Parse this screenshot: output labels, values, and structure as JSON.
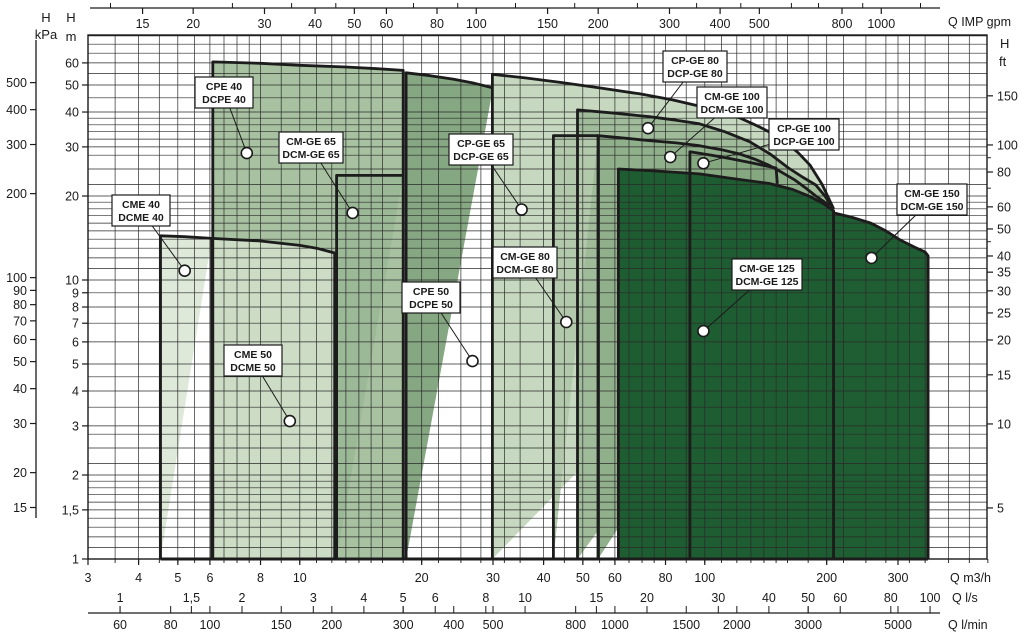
{
  "chart_data": {
    "type": "area",
    "title": "Pump operating range chart",
    "grid": true,
    "scales": {
      "x_log_px": {
        "x0": 88,
        "q0": 3,
        "px_per_decade": 405,
        "right_px": 987
      },
      "y_log_px": {
        "y0": 559,
        "h0": 1,
        "px_per_decade": 279,
        "top_px": 35
      },
      "xlim_m3h": [
        3,
        520
      ],
      "ylim_m": [
        1,
        75
      ]
    },
    "axes": {
      "top_gpm": {
        "label": "Q IMP gpm",
        "factor_to_m3h": 0.27276,
        "ticks": [
          [
            15,
            "15"
          ],
          [
            20,
            "20"
          ],
          [
            30,
            "30"
          ],
          [
            40,
            "40"
          ],
          [
            50,
            "50"
          ],
          [
            60,
            "60"
          ],
          [
            80,
            "80"
          ],
          [
            100,
            "100"
          ],
          [
            150,
            "150"
          ],
          [
            200,
            "200"
          ],
          [
            300,
            "300"
          ],
          [
            400,
            "400"
          ],
          [
            500,
            "500"
          ],
          [
            800,
            "800"
          ],
          [
            1000,
            "1000"
          ]
        ],
        "minor_ticks": [
          12.5,
          25,
          35,
          45,
          70,
          90,
          125,
          175,
          250,
          350,
          450,
          600,
          700,
          900,
          1250,
          1500
        ]
      },
      "bottom_m3h": {
        "label": "Q m3/h",
        "ticks": [
          [
            3,
            "3"
          ],
          [
            4,
            "4"
          ],
          [
            5,
            "5"
          ],
          [
            6,
            "6"
          ],
          [
            8,
            "8"
          ],
          [
            10,
            "10"
          ],
          [
            20,
            "20"
          ],
          [
            30,
            "30"
          ],
          [
            40,
            "40"
          ],
          [
            50,
            "50"
          ],
          [
            60,
            "60"
          ],
          [
            80,
            "80"
          ],
          [
            100,
            "100"
          ],
          [
            200,
            "200"
          ],
          [
            300,
            "300"
          ]
        ]
      },
      "bottom_ls": {
        "label": "Q l/s",
        "factor_to_m3h": 3.6,
        "ticks": [
          [
            1,
            "1"
          ],
          [
            1.5,
            "1,5"
          ],
          [
            2,
            "2"
          ],
          [
            3,
            "3"
          ],
          [
            4,
            "4"
          ],
          [
            5,
            "5"
          ],
          [
            6,
            "6"
          ],
          [
            8,
            "8"
          ],
          [
            10,
            "10"
          ],
          [
            15,
            "15"
          ],
          [
            20,
            "20"
          ],
          [
            30,
            "30"
          ],
          [
            40,
            "40"
          ],
          [
            50,
            "50"
          ],
          [
            60,
            "60"
          ],
          [
            80,
            "80"
          ],
          [
            100,
            "100"
          ]
        ]
      },
      "bottom_lmin": {
        "label": "Q l/min",
        "factor_to_m3h": 0.06,
        "ticks": [
          [
            60,
            "60"
          ],
          [
            80,
            "80"
          ],
          [
            100,
            "100"
          ],
          [
            150,
            "150"
          ],
          [
            200,
            "200"
          ],
          [
            300,
            "300"
          ],
          [
            400,
            "400"
          ],
          [
            500,
            "500"
          ],
          [
            800,
            "800"
          ],
          [
            1000,
            "1000"
          ],
          [
            1500,
            "1500"
          ],
          [
            2000,
            "2000"
          ],
          [
            3000,
            "3000"
          ],
          [
            5000,
            "5000"
          ]
        ]
      },
      "left_kpa": {
        "label_top": "H",
        "label_unit": "kPa",
        "factor_to_m": 0.10197,
        "ticks": [
          [
            500,
            "500"
          ],
          [
            400,
            "400"
          ],
          [
            300,
            "300"
          ],
          [
            200,
            "200"
          ],
          [
            100,
            "100"
          ],
          [
            90,
            "90"
          ],
          [
            80,
            "80"
          ],
          [
            70,
            "70"
          ],
          [
            60,
            "60"
          ],
          [
            50,
            "50"
          ],
          [
            40,
            "40"
          ],
          [
            30,
            "30"
          ],
          [
            20,
            "20"
          ],
          [
            15,
            "15"
          ]
        ]
      },
      "left_m": {
        "label_top": "H",
        "label_unit": "m",
        "ticks": [
          [
            60,
            "60"
          ],
          [
            50,
            "50"
          ],
          [
            40,
            "40"
          ],
          [
            30,
            "30"
          ],
          [
            20,
            "20"
          ],
          [
            10,
            "10"
          ],
          [
            9,
            "9"
          ],
          [
            8,
            "8"
          ],
          [
            7,
            "7"
          ],
          [
            6,
            "6"
          ],
          [
            5,
            "5"
          ],
          [
            4,
            "4"
          ],
          [
            3,
            "3"
          ],
          [
            2,
            "2"
          ],
          [
            1.5,
            "1,5"
          ],
          [
            1,
            "1"
          ]
        ]
      },
      "right_ft": {
        "label_top": "H",
        "label_unit": "ft",
        "factor_to_m": 0.3048,
        "ticks": [
          [
            150,
            "150"
          ],
          [
            100,
            "100"
          ],
          [
            80,
            "80"
          ],
          [
            60,
            "60"
          ],
          [
            50,
            "50"
          ],
          [
            40,
            "40"
          ],
          [
            35,
            "35"
          ],
          [
            30,
            "30"
          ],
          [
            25,
            "25"
          ],
          [
            20,
            "20"
          ],
          [
            15,
            "15"
          ],
          [
            10,
            "10"
          ],
          [
            5,
            "5"
          ]
        ],
        "minor_ticks": [
          90,
          70,
          45
        ]
      }
    },
    "grid_values": {
      "x_m3h": [
        3,
        3.5,
        4,
        4.5,
        5,
        5.5,
        6,
        6.5,
        7,
        7.5,
        8,
        9,
        10,
        11,
        12,
        13,
        14,
        15,
        16,
        18,
        20,
        22,
        25,
        28,
        30,
        32,
        35,
        40,
        45,
        50,
        55,
        60,
        65,
        70,
        75,
        80,
        90,
        100,
        110,
        120,
        130,
        140,
        150,
        160,
        180,
        200,
        220,
        250,
        280,
        300,
        320,
        350,
        400,
        450,
        500
      ],
      "y_m": [
        1,
        1.1,
        1.2,
        1.3,
        1.4,
        1.5,
        1.6,
        1.7,
        1.8,
        1.9,
        2,
        2.2,
        2.5,
        2.8,
        3,
        3.5,
        4,
        4.5,
        5,
        6,
        7,
        8,
        9,
        10,
        11,
        12,
        13,
        14,
        15,
        16,
        17,
        18,
        19,
        20,
        22,
        25,
        28,
        30,
        32,
        34,
        36,
        38,
        40,
        45,
        50,
        55,
        60,
        65,
        70,
        75
      ]
    },
    "envelopes": [
      {
        "id": "cpe-40",
        "lines": [
          "CPE 40",
          "DCPE 40"
        ],
        "fill": "#a8c2a1",
        "outline": [
          [
            6.1,
            1
          ],
          [
            6.1,
            60.5
          ],
          [
            8,
            59.8
          ],
          [
            10,
            58.8
          ],
          [
            13,
            58
          ],
          [
            15.5,
            57.2
          ],
          [
            18,
            56.4
          ],
          [
            18,
            1
          ]
        ],
        "close": true,
        "dot": [
          7.4,
          28.5
        ],
        "box": [
          195,
          77,
          58,
          31
        ]
      },
      {
        "id": "cme-50",
        "lines": [
          "CME 50",
          "DCME 50"
        ],
        "fill": "#ccdcc5",
        "outline": [
          [
            6.06,
            1
          ],
          [
            6.06,
            14.1
          ],
          [
            8,
            13.8
          ],
          [
            10,
            13.3
          ],
          [
            11,
            13
          ],
          [
            12.2,
            12.5
          ],
          [
            12.2,
            1
          ]
        ],
        "close": true,
        "dot": [
          9.45,
          3.12
        ],
        "box": [
          224,
          345,
          58,
          31
        ]
      },
      {
        "id": "cme-40",
        "lines": [
          "CME 40",
          "DCME 40"
        ],
        "fill": "#dfe9da",
        "outline": [
          [
            4.53,
            1
          ],
          [
            4.53,
            14.4
          ],
          [
            5.2,
            14.3
          ],
          [
            6.06,
            14.1
          ]
        ],
        "close": true,
        "dot": [
          5.2,
          10.8
        ],
        "box": [
          112,
          195,
          58,
          31
        ]
      },
      {
        "id": "cm-ge-65",
        "lines": [
          "CM-GE 65",
          "DCM-GE 65"
        ],
        "fill": "#9cb997",
        "outline": [
          [
            12.33,
            1
          ],
          [
            12.33,
            23.7
          ],
          [
            18,
            23.7
          ]
        ],
        "close": true,
        "dot": [
          13.5,
          17.4
        ],
        "box": [
          279,
          132,
          64,
          31
        ]
      },
      {
        "id": "cpe-50",
        "lines": [
          "CPE 50",
          "DCPE 50"
        ],
        "fill": "#85a781",
        "outline": [
          [
            18.3,
            1
          ],
          [
            18.3,
            55.3
          ],
          [
            21,
            54
          ],
          [
            24,
            52.4
          ],
          [
            27,
            50.7
          ],
          [
            30,
            48.8
          ]
        ],
        "close": true,
        "dot": [
          26.7,
          5.12
        ],
        "box": [
          402,
          282,
          58,
          31
        ]
      },
      {
        "id": "cp-ge-65",
        "lines": [
          "CP-GE 65",
          "DCP-GE 65"
        ],
        "fill": "#c6d8bf",
        "outline": [
          [
            29.9,
            1
          ],
          [
            29.9,
            54.6
          ],
          [
            36,
            53
          ],
          [
            44,
            51.1
          ],
          [
            55,
            48.8
          ],
          [
            69,
            46.5
          ],
          [
            83,
            44.3
          ],
          [
            97,
            42
          ],
          [
            110,
            39.9
          ],
          [
            122,
            38.1
          ],
          [
            137,
            35.3
          ],
          [
            154,
            32.3
          ],
          [
            170,
            28.6
          ],
          [
            182,
            25.8
          ],
          [
            195,
            22
          ],
          [
            208,
            18
          ]
        ],
        "close": true,
        "dot": [
          35.3,
          17.9
        ],
        "box": [
          449,
          134,
          64,
          31
        ]
      },
      {
        "id": "cp-ge-80",
        "lines": [
          "CP-GE 80",
          "DCP-GE 80"
        ],
        "fill": "#a0bb9a",
        "outline": [
          [
            48.5,
            1
          ],
          [
            48.5,
            40.7
          ],
          [
            60,
            39.6
          ],
          [
            73,
            38.5
          ],
          [
            85,
            37.4
          ],
          [
            97,
            36.3
          ],
          [
            112,
            34
          ],
          [
            129,
            31.3
          ],
          [
            145,
            28.3
          ],
          [
            161,
            25.2
          ],
          [
            175,
            23.3
          ],
          [
            188,
            21.9
          ],
          [
            198,
            20
          ],
          [
            207,
            18.1
          ]
        ],
        "close": true,
        "dot": [
          72.4,
          35.0
        ],
        "box": [
          663,
          51,
          64,
          31
        ]
      },
      {
        "id": "cm-ge-80",
        "lines": [
          "CM-GE 80",
          "DCM-GE 80"
        ],
        "fill": "#b3c9ac",
        "outline": [
          [
            42.3,
            1
          ],
          [
            42.3,
            32.9
          ],
          [
            54.5,
            32.9
          ]
        ],
        "close": true,
        "dot": [
          45.5,
          7.07
        ],
        "box": [
          493,
          247,
          64,
          31
        ]
      },
      {
        "id": "cm-ge-100",
        "lines": [
          "CM-GE 100",
          "DCM-GE 100"
        ],
        "fill": "#90b08b",
        "outline": [
          [
            54.5,
            1
          ],
          [
            54.5,
            32.9
          ],
          [
            64,
            32.2
          ],
          [
            73,
            31.6
          ],
          [
            85,
            31
          ],
          [
            97,
            30.3
          ],
          [
            110,
            29.3
          ],
          [
            122,
            28.3
          ],
          [
            133,
            27.1
          ],
          [
            144,
            25.8
          ],
          [
            155,
            24.3
          ],
          [
            167,
            22.8
          ],
          [
            178,
            21.3
          ],
          [
            188,
            20
          ],
          [
            196,
            19.2
          ],
          [
            203,
            18.4
          ]
        ],
        "close": true,
        "dot": [
          82.2,
          27.6
        ],
        "box": [
          697,
          87,
          70,
          31
        ]
      },
      {
        "id": "cp-ge-100",
        "lines": [
          "CP-GE 100",
          "DCP-GE 100"
        ],
        "fill": "#86a881",
        "outline": [
          [
            91.9,
            1
          ],
          [
            91.9,
            28.8
          ],
          [
            104,
            28
          ],
          [
            116,
            27.2
          ],
          [
            132,
            26.2
          ],
          [
            150,
            25.2
          ],
          [
            151,
            22.1
          ]
        ],
        "close": true,
        "dot": [
          99.2,
          26.2
        ],
        "box": [
          769,
          119,
          70,
          31
        ]
      },
      {
        "id": "cm-ge-125",
        "lines": [
          "CM-GE 125",
          "DCM-GE 125"
        ],
        "fill": "#1e5c31",
        "outline": [
          [
            61.2,
            1
          ],
          [
            61.2,
            25
          ],
          [
            75,
            24.6
          ],
          [
            97,
            24
          ],
          [
            120,
            23
          ],
          [
            144,
            22.2
          ],
          [
            165,
            21.1
          ],
          [
            182,
            19.9
          ],
          [
            196,
            18.8
          ],
          [
            208,
            17.7
          ],
          [
            208,
            1
          ]
        ],
        "close": true,
        "dot": [
          99.2,
          6.56
        ],
        "box": [
          732,
          259,
          70,
          31
        ]
      },
      {
        "id": "cm-ge-150",
        "lines": [
          "CM-GE 150",
          "DCM-GE 150"
        ],
        "fill": "#1f5e32",
        "outline": [
          [
            208,
            1
          ],
          [
            208,
            17.4
          ],
          [
            230,
            16.8
          ],
          [
            257,
            16
          ],
          [
            280,
            15
          ],
          [
            304,
            13.9
          ],
          [
            330,
            13.1
          ],
          [
            350,
            12.6
          ],
          [
            356,
            12.2
          ],
          [
            356,
            1
          ]
        ],
        "close": true,
        "dot": [
          258,
          12.0
        ],
        "box": [
          897,
          184,
          70,
          31
        ]
      }
    ],
    "overlay_edges": [
      {
        "id": "cp-ge-100-left-edge",
        "pts": [
          [
            91.9,
            25
          ],
          [
            91.9,
            1
          ]
        ],
        "w": 2.2
      },
      {
        "id": "envelope-baseline",
        "pts": [
          [
            4.53,
            1
          ],
          [
            356,
            1
          ]
        ],
        "w": 3
      }
    ],
    "colors": {
      "grid": "#2a2a2a",
      "frame": "#1a1a1a",
      "envelope_border": "#1c1c1c",
      "dot_fill": "#ffffff",
      "label_box_bg": "#ffffff",
      "label_box_border": "#1a1a1a"
    }
  }
}
